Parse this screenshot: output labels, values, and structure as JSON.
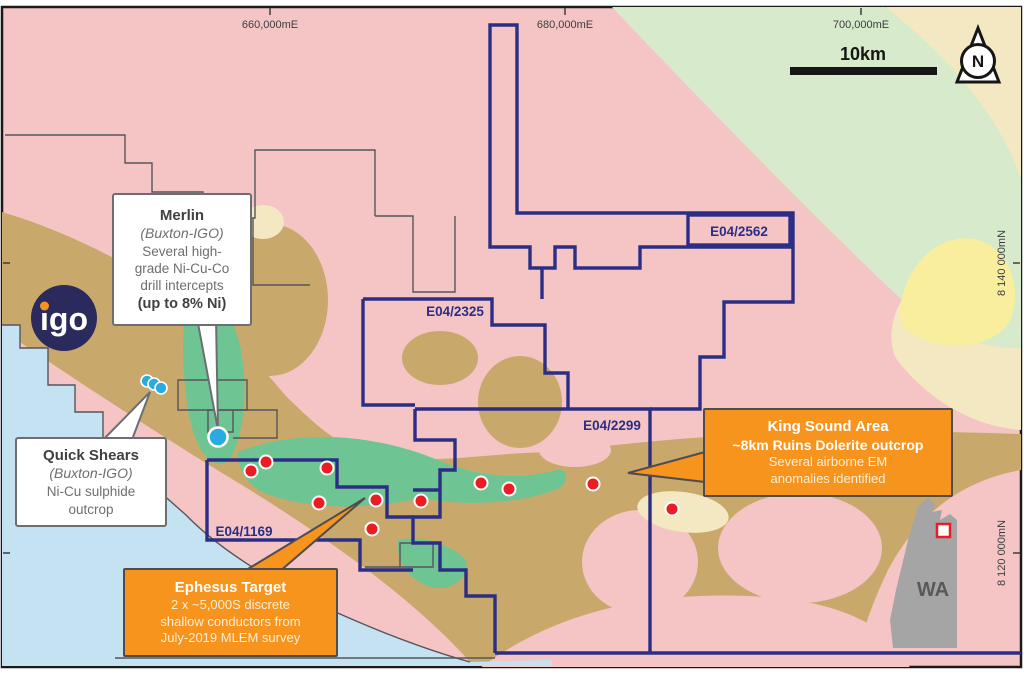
{
  "coordinates": {
    "top": [
      "660,000mE",
      "680,000mE",
      "700,000mE"
    ],
    "right": [
      "8 140 000mN",
      "8 120 000mN"
    ]
  },
  "scalebar": {
    "label": "10km"
  },
  "north": {
    "label": "N"
  },
  "logo": {
    "text": "igo"
  },
  "tenements": {
    "t2562": "E04/2562",
    "t2325": "E04/2325",
    "t2299": "E04/2299",
    "t1169": "E04/1169"
  },
  "callouts": {
    "merlin": {
      "title": "Merlin",
      "subtitle": "(Buxton-IGO)",
      "line1": "Several high-",
      "line2": "grade Ni-Cu-Co",
      "line3": "drill intercepts",
      "bold": "(up to 8% Ni)"
    },
    "quick_shears": {
      "title": "Quick Shears",
      "subtitle": "(Buxton-IGO)",
      "line1": "Ni-Cu sulphide",
      "line2": "outcrop"
    },
    "king_sound": {
      "title": "King Sound Area",
      "bold": "~8km Ruins Dolerite outcrop",
      "line1": "Several airborne EM",
      "line2": "anomalies identified"
    },
    "ephesus": {
      "title": "Ephesus Target",
      "line1": "2 x ~5,000S discrete",
      "line2": "shallow conductors from",
      "line3": "July-2019 MLEM survey"
    }
  },
  "inset": {
    "label": "WA"
  },
  "colors": {
    "pink": "#F5C5C6",
    "tan": "#C8A96B",
    "pale_green": "#D7EACB",
    "bright_green": "#6FC494",
    "cream": "#F4E8C2",
    "yellow": "#F9EE9E",
    "water": "#C4E2F2",
    "tenement_navy": "#2B2E84",
    "callout_orange": "#F7941D",
    "red_dot": "#EC1C24",
    "blue_dot": "#29ABE2"
  }
}
